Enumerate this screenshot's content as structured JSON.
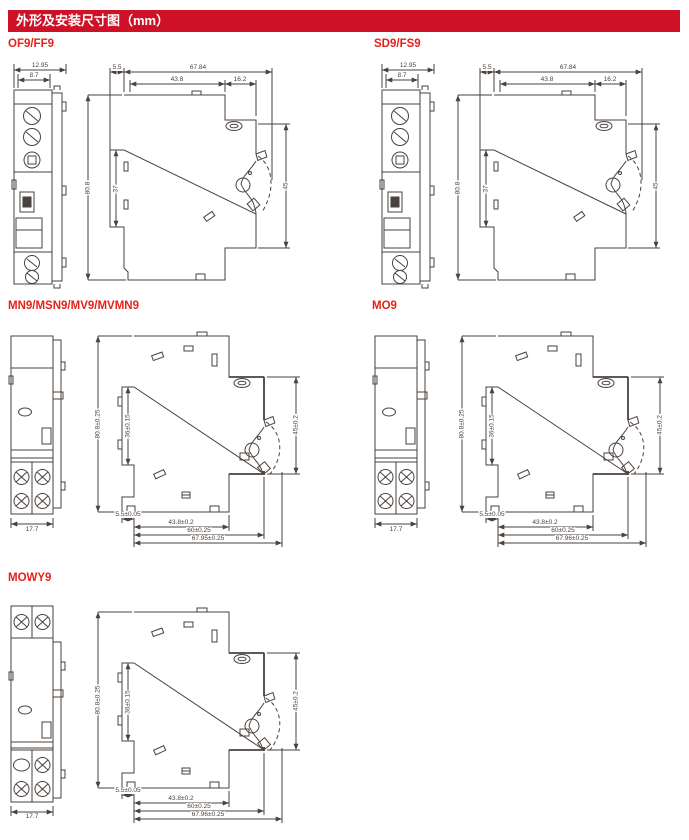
{
  "header": {
    "title": "外形及安装尺寸图（mm）"
  },
  "colors": {
    "header_bg": "#ce1126",
    "section_label": "#e2231a",
    "line": "#4a423e"
  },
  "sections": [
    {
      "label": "OF9/FF9",
      "side": {
        "overall_width": "12.95",
        "inner_width": "8.7"
      },
      "main": {
        "front_offset": "5.5",
        "total_width": "67.84",
        "body_width": "43.8",
        "clip_width": "16.2",
        "height": "80.8",
        "panel_height": "37",
        "rail_height": "45"
      }
    },
    {
      "label": "SD9/FS9",
      "side": {
        "overall_width": "12.95",
        "inner_width": "8.7"
      },
      "main": {
        "front_offset": "5.5",
        "total_width": "67.84",
        "body_width": "43.8",
        "clip_width": "16.2",
        "height": "80.8",
        "panel_height": "37",
        "rail_height": "45"
      }
    },
    {
      "label": "MN9/MSN9/MV9/MVMN9",
      "side": {
        "bottom_width": "17.7"
      },
      "main": {
        "height": "80.8±0.25",
        "panel_height": "36±0.15",
        "rail_height": "45±0.2",
        "front_offset": "5.5±0.05",
        "body_width": "43.8±0.2",
        "mid_width": "60±0.25",
        "total_width": "67.95±0.25"
      }
    },
    {
      "label": "MO9",
      "side": {
        "bottom_width": "17.7"
      },
      "main": {
        "height": "80.8±0.25",
        "panel_height": "36±0.15",
        "rail_height": "45±0.2",
        "front_offset": "5.5±0.05",
        "body_width": "43.8±0.2",
        "mid_width": "60±0.25",
        "total_width": "67.96±0.25"
      }
    },
    {
      "label": "MOWY9",
      "side": {
        "bottom_width": "17.7"
      },
      "main": {
        "height": "80.8±0.25",
        "panel_height": "36±0.15",
        "rail_height": "45±0.2",
        "front_offset": "5.5±0.05",
        "body_width": "43.8±0.2",
        "mid_width": "60±0.25",
        "total_width": "67.96±0.25"
      }
    }
  ]
}
